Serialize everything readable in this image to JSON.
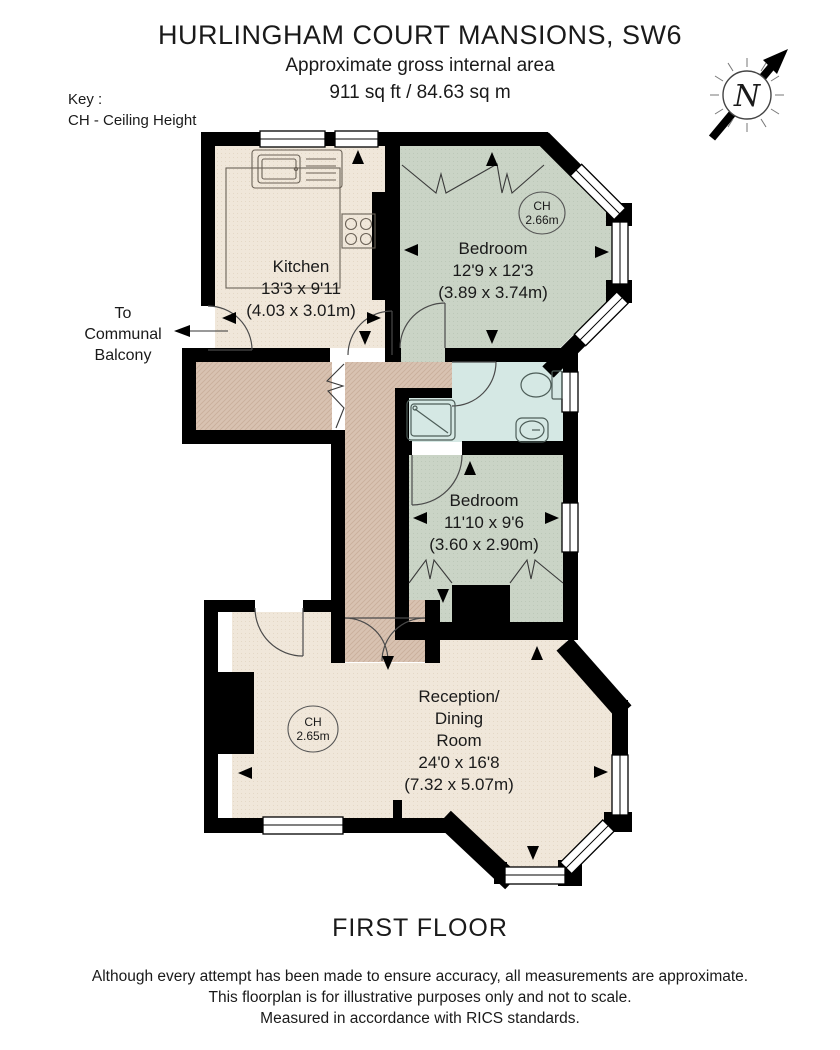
{
  "header": {
    "title": "HURLINGHAM COURT MANSIONS, SW6",
    "subtitle": "Approximate gross internal area",
    "area": "911 sq ft / 84.63 sq m"
  },
  "key": {
    "line1": "Key :",
    "line2": "CH - Ceiling Height"
  },
  "compass": {
    "north_label": "N"
  },
  "rooms": {
    "kitchen": {
      "name": "Kitchen",
      "dims_imperial": "13'3 x 9'11",
      "dims_metric": "(4.03 x 3.01m)"
    },
    "bedroom1": {
      "name": "Bedroom",
      "dims_imperial": "12'9 x 12'3",
      "dims_metric": "(3.89 x 3.74m)",
      "ch_label": "CH",
      "ch_value": "2.66m"
    },
    "bedroom2": {
      "name": "Bedroom",
      "dims_imperial": "11'10 x 9'6",
      "dims_metric": "(3.60 x 2.90m)"
    },
    "reception": {
      "name_line1": "Reception/",
      "name_line2": "Dining",
      "name_line3": "Room",
      "dims_imperial": "24'0 x 16'8",
      "dims_metric": "(7.32 x 5.07m)",
      "ch_label": "CH",
      "ch_value": "2.65m"
    }
  },
  "annotations": {
    "balcony_line1": "To",
    "balcony_line2": "Communal",
    "balcony_line3": "Balcony"
  },
  "floor_label": "FIRST FLOOR",
  "disclaimer": {
    "line1": "Although every attempt has been made to ensure accuracy, all measurements are approximate.",
    "line2": "This floorplan is for illustrative purposes only and not to scale.",
    "line3": "Measured in accordance with RICS standards."
  },
  "colors": {
    "wall": "#000000",
    "kitchen_reception_fill": "#f0e7da",
    "bedroom_fill": "#cad4c6",
    "bathroom_fill": "#d5e8e4",
    "hallway_fill": "#d8c2b1",
    "text": "#1a1a1a"
  }
}
